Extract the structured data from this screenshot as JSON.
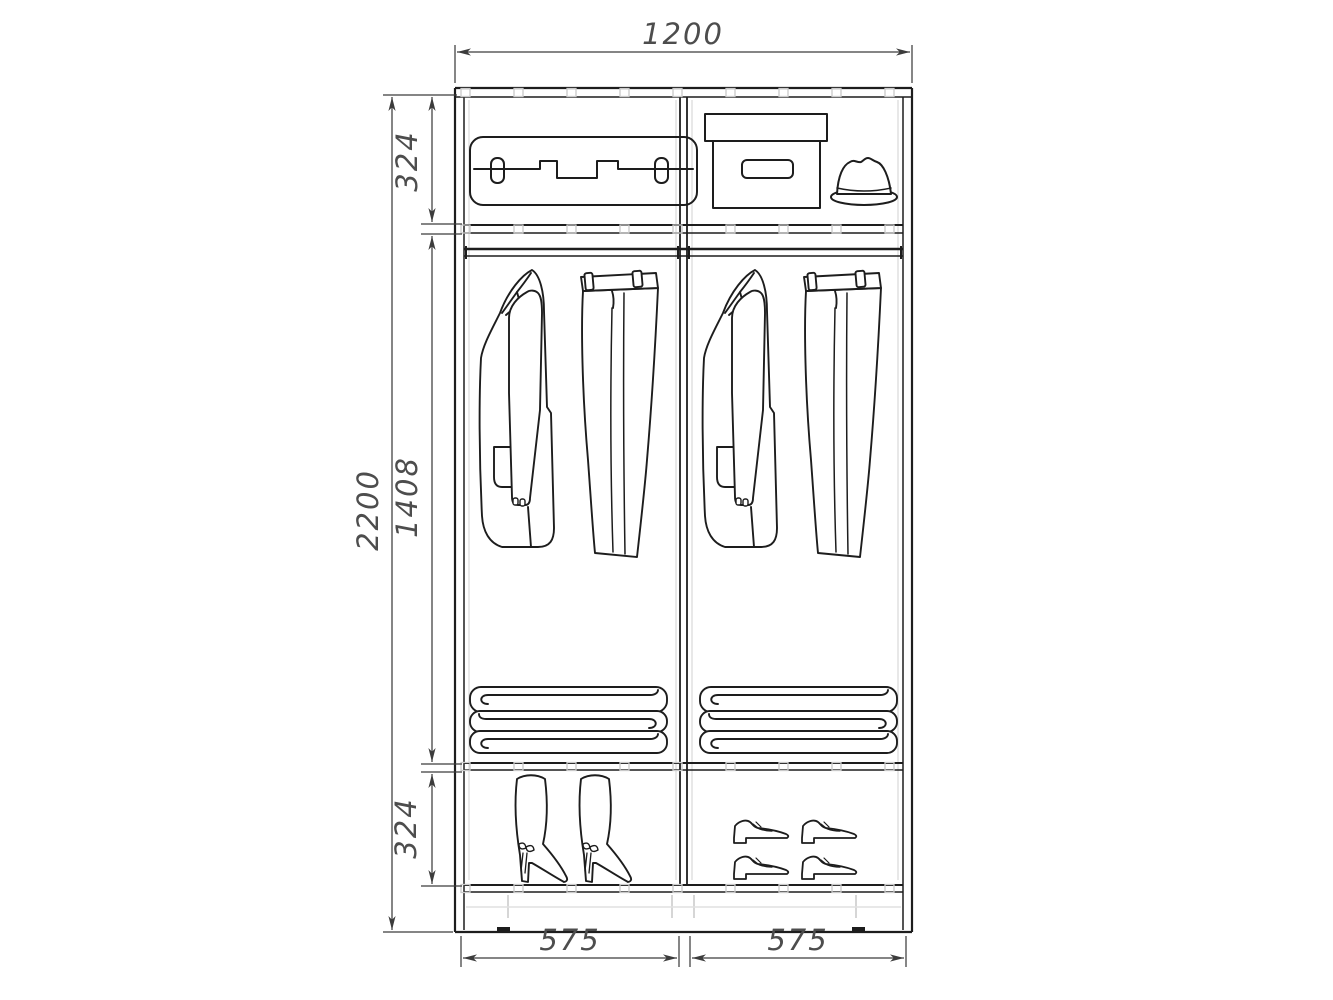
{
  "drawing": {
    "kind": "wardrobe-interior-elevation",
    "labels": {
      "overall_width_mm": "1200",
      "overall_height_mm": "2200",
      "top_section_mm": "324",
      "hanging_section_mm": "1408",
      "bottom_section_mm": "324",
      "left_bay_mm": "575",
      "right_bay_mm": "575"
    },
    "colors": {
      "line": "#1d1d1d",
      "dim_line": "#3c3c3c",
      "dim_text": "#4d4d4d",
      "detail_gray": "#c9c9c9",
      "background": "#ffffff"
    },
    "icons": {
      "top_shelf": [
        "suitcase-icon",
        "storage-box-icon",
        "fedora-hat-icon"
      ],
      "left_bay": [
        "jacket-icon",
        "trousers-icon",
        "folded-blankets-icon",
        "high-boots-icon"
      ],
      "right_bay": [
        "jacket-icon",
        "trousers-icon",
        "folded-blankets-icon",
        "mens-shoes-icon"
      ]
    }
  }
}
